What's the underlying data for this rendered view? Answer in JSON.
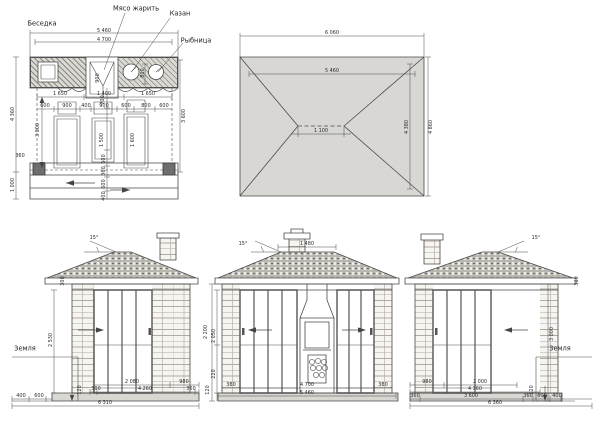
{
  "sheet": {
    "type_label": "архитектурный чертёж",
    "colors": {
      "line": "#4a4a4a",
      "roof_fill": "#d8d7d3",
      "tile": "#b9b6b0",
      "brick_joint": "#b1aba1",
      "column_fill": "#6e6e6e"
    }
  },
  "plan": {
    "title": "Беседка",
    "callouts": {
      "grill": "Мясо жарить",
      "kazan": "Казан",
      "fish": "Рыбница"
    },
    "dims": {
      "top_outer": "5 460",
      "top_inner": "4 700",
      "left_outer": "4 360",
      "left_lower": "1 000",
      "left_step": "360",
      "row1": [
        "1 650",
        "1 400",
        "1 650"
      ],
      "row2": [
        "600",
        "900",
        "400",
        "900",
        "600",
        "800",
        "600"
      ],
      "v_left": "3 000",
      "v_right": "3 600",
      "table_mid": "1 500",
      "table_right": "1 600",
      "grill_depth": "900",
      "counter_gap": "700",
      "kazan_gap": "800",
      "chain": [
        "500",
        "360",
        "600",
        "400"
      ]
    }
  },
  "roof": {
    "dims": {
      "outer_w": "6 060",
      "inner_w": "5 460",
      "ridge": "1 100",
      "inner_h": "4 380",
      "outer_h": "4 860"
    }
  },
  "elevations": {
    "left": {
      "angle": "15°",
      "ground": "Земля",
      "height": "2 530",
      "eaves": "300",
      "step_h": "120",
      "row1": [
        "2 080",
        "980"
      ],
      "row2": [
        "300",
        "4 260",
        "360"
      ],
      "row3": [
        "400",
        "600"
      ],
      "overall": "6 310"
    },
    "middle": {
      "angle": "15°",
      "chimney_w": "1 480",
      "v1": "2 200",
      "v2": "2 050",
      "v3": "220",
      "v4": "120",
      "row1": [
        "380",
        "4 700",
        "380"
      ],
      "overall": "5 460"
    },
    "right": {
      "angle": "15°",
      "ground": "Земля",
      "height": "3 000",
      "eaves": "300",
      "step_h": "120",
      "row1": [
        "980",
        "2 000"
      ],
      "row2": [
        "4 360"
      ],
      "row3": [
        "360",
        "3 600",
        "360",
        "600",
        "400"
      ],
      "overall": "6 360"
    }
  }
}
